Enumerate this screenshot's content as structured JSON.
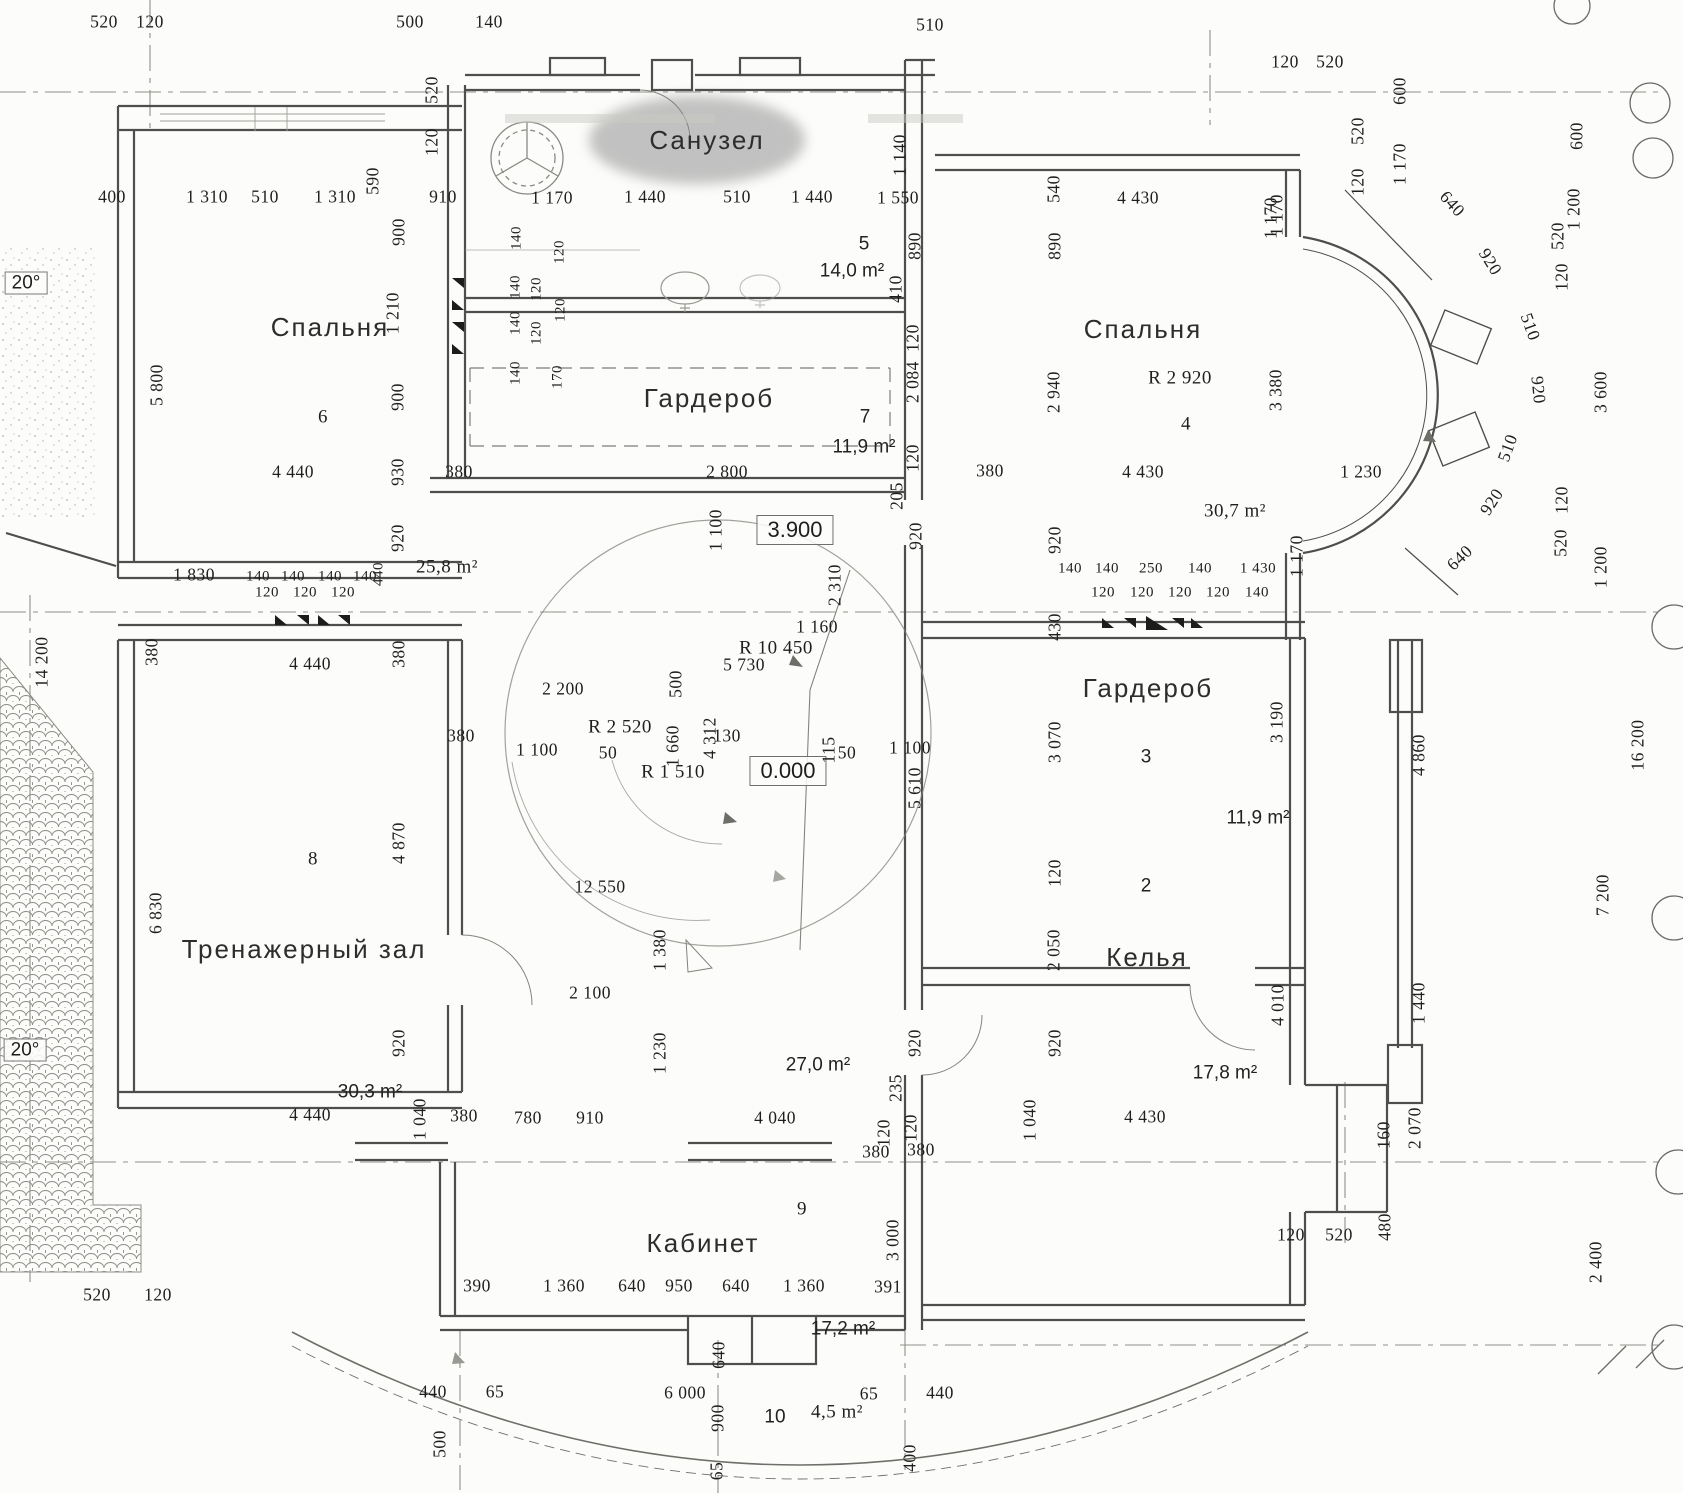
{
  "title": "Поэтажный план (скан) — Санузел / Спальни / Гардеробы / Тренажерный зал / Келья / Кабинет",
  "rooms": [
    {
      "name": "Санузел",
      "number": "5",
      "area": "14,0 m²"
    },
    {
      "name": "Спальня",
      "number": "6",
      "area": "25,8 m²"
    },
    {
      "name": "Гардероб",
      "number": "7",
      "area": "11,9 m²"
    },
    {
      "name": "Спальня",
      "number": "4",
      "area": "30,7 m²",
      "radius": "R 2 920"
    },
    {
      "name": "Гардероб",
      "number": "3",
      "area": "11,9 m²"
    },
    {
      "name": "Келья",
      "number": "2",
      "area": "17,8 m²"
    },
    {
      "name": "Тренажерный зал",
      "number": "8",
      "area": "30,3 m²"
    },
    {
      "name": "Кабинет",
      "number": "9",
      "area": "17,2 m²"
    },
    {
      "name": "Балкон",
      "number": "10",
      "area": "4,5 m²"
    }
  ],
  "levels": [
    "3.900",
    "0.000"
  ],
  "slopes": [
    "20°",
    "20°"
  ],
  "radii": [
    "R 10 450",
    "R 2 920",
    "R 2 520",
    "R 1 510"
  ],
  "labels": [
    {
      "t": "520",
      "x": 104,
      "y": 22
    },
    {
      "t": "120",
      "x": 150,
      "y": 22
    },
    {
      "t": "500",
      "x": 410,
      "y": 22
    },
    {
      "t": "140",
      "x": 489,
      "y": 22
    },
    {
      "t": "510",
      "x": 930,
      "y": 25
    },
    {
      "t": "120",
      "x": 1285,
      "y": 62
    },
    {
      "t": "520",
      "x": 1330,
      "y": 62
    },
    {
      "t": "600",
      "x": 1400,
      "y": 91,
      "a": -90
    },
    {
      "t": "520",
      "x": 1358,
      "y": 131,
      "a": -90
    },
    {
      "t": "120",
      "x": 1358,
      "y": 182,
      "a": -90
    },
    {
      "t": "1 170",
      "x": 1400,
      "y": 164,
      "a": -90
    },
    {
      "t": "600",
      "x": 1577,
      "y": 136,
      "a": -90
    },
    {
      "t": "1 200",
      "x": 1574,
      "y": 209,
      "a": -90
    },
    {
      "t": "1 170",
      "x": 1271,
      "y": 218,
      "a": -90
    },
    {
      "t": "640",
      "x": 1452,
      "y": 204,
      "a": 48
    },
    {
      "t": "920",
      "x": 1490,
      "y": 262,
      "a": 58
    },
    {
      "t": "520",
      "x": 1558,
      "y": 236,
      "a": -90
    },
    {
      "t": "120",
      "x": 1562,
      "y": 277,
      "a": -90
    },
    {
      "t": "510",
      "x": 1530,
      "y": 327,
      "a": 70
    },
    {
      "t": "920",
      "x": 1538,
      "y": 390,
      "a": 84
    },
    {
      "t": "3 600",
      "x": 1601,
      "y": 392,
      "a": -90
    },
    {
      "t": "510",
      "x": 1508,
      "y": 448,
      "a": -70
    },
    {
      "t": "920",
      "x": 1492,
      "y": 502,
      "a": -57
    },
    {
      "t": "640",
      "x": 1460,
      "y": 558,
      "a": -44
    },
    {
      "t": "120",
      "x": 1562,
      "y": 500,
      "a": -90
    },
    {
      "t": "520",
      "x": 1561,
      "y": 543,
      "a": -90
    },
    {
      "t": "1 200",
      "x": 1601,
      "y": 567,
      "a": -90
    },
    {
      "t": "1 230",
      "x": 1361,
      "y": 472
    },
    {
      "t": "3 380",
      "x": 1276,
      "y": 390,
      "a": -90
    },
    {
      "t": "1 170",
      "x": 1297,
      "y": 556,
      "a": -90
    },
    {
      "t": "400",
      "x": 112,
      "y": 197
    },
    {
      "t": "1 310",
      "x": 207,
      "y": 197
    },
    {
      "t": "510",
      "x": 265,
      "y": 197
    },
    {
      "t": "1 310",
      "x": 335,
      "y": 197
    },
    {
      "t": "590",
      "x": 373,
      "y": 181,
      "a": -90
    },
    {
      "t": "910",
      "x": 443,
      "y": 197
    },
    {
      "t": "1 170",
      "x": 552,
      "y": 198
    },
    {
      "t": "1 440",
      "x": 645,
      "y": 197
    },
    {
      "t": "510",
      "x": 737,
      "y": 197
    },
    {
      "t": "1 440",
      "x": 812,
      "y": 197
    },
    {
      "t": "1 550",
      "x": 898,
      "y": 198
    },
    {
      "t": "520",
      "x": 432,
      "y": 90,
      "a": -90
    },
    {
      "t": "120",
      "x": 432,
      "y": 142,
      "a": -90
    },
    {
      "t": "1 140",
      "x": 900,
      "y": 155,
      "a": -90
    },
    {
      "t": "890",
      "x": 915,
      "y": 246,
      "a": -90
    },
    {
      "t": "410",
      "x": 896,
      "y": 289,
      "a": -90
    },
    {
      "t": "5",
      "x": 864,
      "y": 244,
      "k": "s",
      "s": 19
    },
    {
      "t": "14,0 m²",
      "x": 852,
      "y": 271,
      "k": "s",
      "s": 19
    },
    {
      "t": "540",
      "x": 1054,
      "y": 189,
      "a": -90
    },
    {
      "t": "4 430",
      "x": 1138,
      "y": 198
    },
    {
      "t": "890",
      "x": 1055,
      "y": 246,
      "a": -90
    },
    {
      "t": "1 170",
      "x": 1277,
      "y": 215,
      "a": -90
    },
    {
      "t": "Спальня",
      "x": 1143,
      "y": 329,
      "k": "r"
    },
    {
      "t": "R 2 920",
      "x": 1180,
      "y": 378,
      "s": 19
    },
    {
      "t": "4",
      "x": 1186,
      "y": 424,
      "s": 19
    },
    {
      "t": "2 940",
      "x": 1054,
      "y": 392,
      "a": -90
    },
    {
      "t": "4 430",
      "x": 1143,
      "y": 472
    },
    {
      "t": "380",
      "x": 990,
      "y": 471
    },
    {
      "t": "30,7 m²",
      "x": 1235,
      "y": 511,
      "s": 19
    },
    {
      "t": "205",
      "x": 897,
      "y": 496,
      "a": -90
    },
    {
      "t": "120",
      "x": 913,
      "y": 338,
      "a": -90
    },
    {
      "t": "2 084",
      "x": 913,
      "y": 382,
      "a": -90
    },
    {
      "t": "120",
      "x": 913,
      "y": 458,
      "a": -90
    },
    {
      "t": "920",
      "x": 916,
      "y": 536,
      "a": -90
    },
    {
      "t": "Спальня",
      "x": 330,
      "y": 327,
      "k": "r"
    },
    {
      "t": "900",
      "x": 399,
      "y": 232,
      "a": -90
    },
    {
      "t": "1 210",
      "x": 393,
      "y": 313,
      "a": -90
    },
    {
      "t": "900",
      "x": 398,
      "y": 397,
      "a": -90
    },
    {
      "t": "5 800",
      "x": 157,
      "y": 385,
      "a": -90
    },
    {
      "t": "6",
      "x": 323,
      "y": 417,
      "s": 19
    },
    {
      "t": "4 440",
      "x": 293,
      "y": 472
    },
    {
      "t": "930",
      "x": 398,
      "y": 472,
      "a": -90
    },
    {
      "t": "380",
      "x": 459,
      "y": 472
    },
    {
      "t": "920",
      "x": 398,
      "y": 538,
      "a": -90
    },
    {
      "t": "25,8 m²",
      "x": 447,
      "y": 567,
      "s": 19
    },
    {
      "t": "1 830",
      "x": 194,
      "y": 575
    },
    {
      "t": "140",
      "x": 258,
      "y": 577,
      "s": 15
    },
    {
      "t": "140",
      "x": 293,
      "y": 577,
      "s": 15
    },
    {
      "t": "140",
      "x": 330,
      "y": 577,
      "s": 15
    },
    {
      "t": "140",
      "x": 365,
      "y": 577,
      "s": 15
    },
    {
      "t": "440",
      "x": 379,
      "y": 574,
      "a": -90,
      "s": 15
    },
    {
      "t": "120",
      "x": 267,
      "y": 593,
      "s": 15
    },
    {
      "t": "120",
      "x": 305,
      "y": 593,
      "s": 15
    },
    {
      "t": "120",
      "x": 343,
      "y": 593,
      "s": 15
    },
    {
      "t": "140",
      "x": 517,
      "y": 238,
      "a": -90,
      "s": 15
    },
    {
      "t": "120",
      "x": 560,
      "y": 252,
      "a": -90,
      "s": 15
    },
    {
      "t": "140",
      "x": 516,
      "y": 287,
      "a": -90,
      "s": 15
    },
    {
      "t": "120",
      "x": 537,
      "y": 289,
      "a": -90,
      "s": 15
    },
    {
      "t": "120",
      "x": 561,
      "y": 310,
      "a": -90,
      "s": 15
    },
    {
      "t": "140",
      "x": 516,
      "y": 323,
      "a": -90,
      "s": 15
    },
    {
      "t": "120",
      "x": 537,
      "y": 333,
      "a": -90,
      "s": 15
    },
    {
      "t": "140",
      "x": 516,
      "y": 373,
      "a": -90,
      "s": 15
    },
    {
      "t": "170",
      "x": 558,
      "y": 377,
      "a": -90,
      "s": 15
    },
    {
      "t": "Санузел",
      "x": 707,
      "y": 140,
      "k": "r"
    },
    {
      "t": "Гардероб",
      "x": 709,
      "y": 398,
      "k": "r"
    },
    {
      "t": "7",
      "x": 865,
      "y": 417,
      "k": "s",
      "s": 19
    },
    {
      "t": "11,9 m²",
      "x": 864,
      "y": 447,
      "k": "s",
      "s": 19
    },
    {
      "t": "2 800",
      "x": 727,
      "y": 472
    },
    {
      "t": "1 100",
      "x": 716,
      "y": 530,
      "a": -90
    },
    {
      "t": "3.900",
      "x": 795,
      "y": 530,
      "k": "lv"
    },
    {
      "t": "2 310",
      "x": 835,
      "y": 585,
      "a": -90
    },
    {
      "t": "1 160",
      "x": 817,
      "y": 627
    },
    {
      "t": "R 10 450",
      "x": 776,
      "y": 648,
      "s": 19
    },
    {
      "t": "5 730",
      "x": 744,
      "y": 665
    },
    {
      "t": "500",
      "x": 676,
      "y": 684,
      "a": -90
    },
    {
      "t": "2 200",
      "x": 563,
      "y": 689
    },
    {
      "t": "R 2 520",
      "x": 620,
      "y": 727,
      "s": 19
    },
    {
      "t": "1 100",
      "x": 537,
      "y": 750
    },
    {
      "t": "50",
      "x": 608,
      "y": 753
    },
    {
      "t": "1 660",
      "x": 673,
      "y": 746,
      "a": -90
    },
    {
      "t": "4 312",
      "x": 710,
      "y": 738,
      "a": -90
    },
    {
      "t": "130",
      "x": 727,
      "y": 736
    },
    {
      "t": "R 1 510",
      "x": 673,
      "y": 772,
      "s": 19
    },
    {
      "t": "0.000",
      "x": 788,
      "y": 771,
      "k": "lv"
    },
    {
      "t": "50",
      "x": 847,
      "y": 753
    },
    {
      "t": "1 100",
      "x": 910,
      "y": 748
    },
    {
      "t": "115",
      "x": 829,
      "y": 750,
      "a": -90
    },
    {
      "t": "5 610",
      "x": 915,
      "y": 788,
      "a": -90
    },
    {
      "t": "140",
      "x": 1070,
      "y": 569,
      "s": 15
    },
    {
      "t": "140",
      "x": 1107,
      "y": 569,
      "s": 15
    },
    {
      "t": "250",
      "x": 1151,
      "y": 569,
      "s": 15
    },
    {
      "t": "140",
      "x": 1200,
      "y": 569,
      "s": 15
    },
    {
      "t": "1 430",
      "x": 1258,
      "y": 569,
      "s": 15
    },
    {
      "t": "120",
      "x": 1103,
      "y": 593,
      "s": 15
    },
    {
      "t": "120",
      "x": 1142,
      "y": 593,
      "s": 15
    },
    {
      "t": "120",
      "x": 1180,
      "y": 593,
      "s": 15
    },
    {
      "t": "120",
      "x": 1218,
      "y": 593,
      "s": 15
    },
    {
      "t": "140",
      "x": 1257,
      "y": 593,
      "s": 15
    },
    {
      "t": "920",
      "x": 1055,
      "y": 540,
      "a": -90
    },
    {
      "t": "430",
      "x": 1055,
      "y": 627,
      "a": -90
    },
    {
      "t": "Гардероб",
      "x": 1148,
      "y": 688,
      "k": "r"
    },
    {
      "t": "3 070",
      "x": 1055,
      "y": 742,
      "a": -90
    },
    {
      "t": "3",
      "x": 1146,
      "y": 757,
      "k": "s",
      "s": 19
    },
    {
      "t": "3 190",
      "x": 1277,
      "y": 722,
      "a": -90
    },
    {
      "t": "11,9 m²",
      "x": 1258,
      "y": 818,
      "k": "s",
      "s": 19
    },
    {
      "t": "120",
      "x": 1055,
      "y": 873,
      "a": -90
    },
    {
      "t": "2",
      "x": 1146,
      "y": 886,
      "k": "s",
      "s": 19
    },
    {
      "t": "Келья",
      "x": 1147,
      "y": 957,
      "k": "r"
    },
    {
      "t": "2 050",
      "x": 1054,
      "y": 950,
      "a": -90
    },
    {
      "t": "4 010",
      "x": 1278,
      "y": 1005,
      "a": -90
    },
    {
      "t": "920",
      "x": 1055,
      "y": 1043,
      "a": -90
    },
    {
      "t": "17,8 m²",
      "x": 1225,
      "y": 1073,
      "k": "s",
      "s": 19
    },
    {
      "t": "1 040",
      "x": 1030,
      "y": 1120,
      "a": -90
    },
    {
      "t": "4 430",
      "x": 1145,
      "y": 1117
    },
    {
      "t": "920",
      "x": 915,
      "y": 1043,
      "a": -90
    },
    {
      "t": "120",
      "x": 911,
      "y": 1128,
      "a": -90
    },
    {
      "t": "380",
      "x": 921,
      "y": 1150
    },
    {
      "t": "3 000",
      "x": 893,
      "y": 1240,
      "a": -90
    },
    {
      "t": "391",
      "x": 888,
      "y": 1287
    },
    {
      "t": "380",
      "x": 152,
      "y": 652,
      "a": -90
    },
    {
      "t": "4 440",
      "x": 310,
      "y": 664
    },
    {
      "t": "380",
      "x": 399,
      "y": 654,
      "a": -90
    },
    {
      "t": "380",
      "x": 461,
      "y": 736
    },
    {
      "t": "8",
      "x": 313,
      "y": 859,
      "s": 19
    },
    {
      "t": "4 870",
      "x": 399,
      "y": 843,
      "a": -90
    },
    {
      "t": "6 830",
      "x": 156,
      "y": 913,
      "a": -90
    },
    {
      "t": "Тренажерный зал",
      "x": 304,
      "y": 949,
      "k": "r"
    },
    {
      "t": "920",
      "x": 399,
      "y": 1043,
      "a": -90
    },
    {
      "t": "30,3 m²",
      "x": 370,
      "y": 1092,
      "k": "s",
      "s": 19
    },
    {
      "t": "4 440",
      "x": 310,
      "y": 1115
    },
    {
      "t": "1 040",
      "x": 420,
      "y": 1119,
      "a": -90
    },
    {
      "t": "380",
      "x": 464,
      "y": 1116
    },
    {
      "t": "780",
      "x": 528,
      "y": 1118
    },
    {
      "t": "910",
      "x": 590,
      "y": 1118
    },
    {
      "t": "4 040",
      "x": 775,
      "y": 1118
    },
    {
      "t": "120",
      "x": 884,
      "y": 1133,
      "a": -90
    },
    {
      "t": "380",
      "x": 876,
      "y": 1152
    },
    {
      "t": "235",
      "x": 896,
      "y": 1088,
      "a": -90
    },
    {
      "t": "9",
      "x": 802,
      "y": 1209,
      "s": 19
    },
    {
      "t": "Кабинет",
      "x": 703,
      "y": 1243,
      "k": "r"
    },
    {
      "t": "390",
      "x": 477,
      "y": 1286
    },
    {
      "t": "1 360",
      "x": 564,
      "y": 1286
    },
    {
      "t": "640",
      "x": 632,
      "y": 1286
    },
    {
      "t": "950",
      "x": 679,
      "y": 1286
    },
    {
      "t": "640",
      "x": 736,
      "y": 1286
    },
    {
      "t": "1 360",
      "x": 804,
      "y": 1286
    },
    {
      "t": "17,2 m²",
      "x": 843,
      "y": 1329,
      "k": "s",
      "s": 19
    },
    {
      "t": "440",
      "x": 433,
      "y": 1392
    },
    {
      "t": "65",
      "x": 495,
      "y": 1392
    },
    {
      "t": "6 000",
      "x": 685,
      "y": 1393
    },
    {
      "t": "640",
      "x": 719,
      "y": 1355,
      "a": -90
    },
    {
      "t": "900",
      "x": 718,
      "y": 1418,
      "a": -90
    },
    {
      "t": "65",
      "x": 717,
      "y": 1471,
      "a": -90
    },
    {
      "t": "10",
      "x": 775,
      "y": 1417,
      "k": "s",
      "s": 19
    },
    {
      "t": "4,5 m²",
      "x": 837,
      "y": 1412,
      "s": 19
    },
    {
      "t": "65",
      "x": 869,
      "y": 1394
    },
    {
      "t": "440",
      "x": 940,
      "y": 1393
    },
    {
      "t": "400",
      "x": 910,
      "y": 1458,
      "a": -90
    },
    {
      "t": "500",
      "x": 440,
      "y": 1444,
      "a": -90
    },
    {
      "t": "520",
      "x": 97,
      "y": 1295
    },
    {
      "t": "120",
      "x": 158,
      "y": 1295
    },
    {
      "t": "20°",
      "x": 26,
      "y": 283,
      "k": "ang"
    },
    {
      "t": "20°",
      "x": 25,
      "y": 1050,
      "k": "ang"
    },
    {
      "t": "14 200",
      "x": 42,
      "y": 662,
      "a": -90
    },
    {
      "t": "160",
      "x": 1384,
      "y": 1135,
      "a": -90
    },
    {
      "t": "2 070",
      "x": 1415,
      "y": 1128,
      "a": -90
    },
    {
      "t": "120",
      "x": 1291,
      "y": 1235
    },
    {
      "t": "520",
      "x": 1339,
      "y": 1235
    },
    {
      "t": "480",
      "x": 1385,
      "y": 1227,
      "a": -90
    },
    {
      "t": "2 400",
      "x": 1596,
      "y": 1262,
      "a": -90
    },
    {
      "t": "4 860",
      "x": 1419,
      "y": 755,
      "a": -90
    },
    {
      "t": "16 200",
      "x": 1638,
      "y": 745,
      "a": -90
    },
    {
      "t": "7 200",
      "x": 1603,
      "y": 895,
      "a": -90
    },
    {
      "t": "1 440",
      "x": 1419,
      "y": 1003,
      "a": -90
    },
    {
      "t": "12 550",
      "x": 600,
      "y": 887
    },
    {
      "t": "1 380",
      "x": 660,
      "y": 950,
      "a": -90
    },
    {
      "t": "2 100",
      "x": 590,
      "y": 993
    },
    {
      "t": "1 230",
      "x": 660,
      "y": 1053,
      "a": -90
    },
    {
      "t": "27,0 m²",
      "x": 818,
      "y": 1065,
      "k": "s",
      "s": 19
    }
  ]
}
